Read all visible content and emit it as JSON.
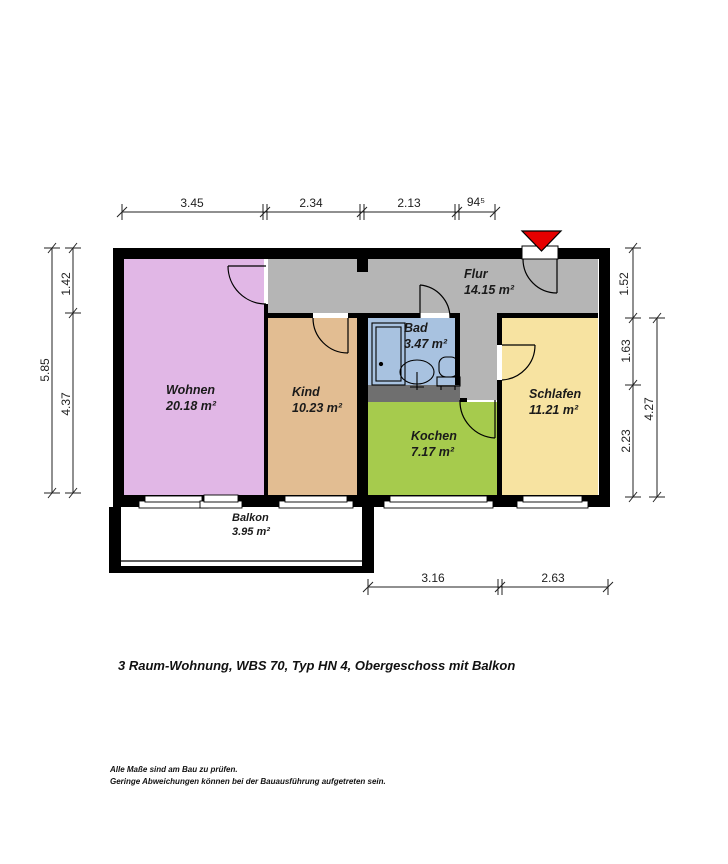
{
  "plan": {
    "rooms": [
      {
        "name": "Wohnen",
        "area": "20.18 m²",
        "color": "#e1b7e6"
      },
      {
        "name": "Kind",
        "area": "10.23 m²",
        "color": "#e2bd92"
      },
      {
        "name": "Flur",
        "area": "14.15 m²",
        "color": "#b5b5b5"
      },
      {
        "name": "Bad",
        "area": "3.47 m²",
        "color": "#a8c2e0"
      },
      {
        "name": "Kochen",
        "area": "7.17 m²",
        "color": "#a6cb4d"
      },
      {
        "name": "Schlafen",
        "area": "11.21 m²",
        "color": "#f7e3a1"
      },
      {
        "name": "Balkon",
        "area": "3.95 m²",
        "color": "#ffffff"
      }
    ],
    "dims": {
      "top": [
        "3.45",
        "2.34",
        "2.13",
        "94⁵"
      ],
      "left": [
        "1.42",
        "5.85",
        "4.37"
      ],
      "right": [
        "1.52",
        "1.63",
        "2.23",
        "4.27"
      ],
      "bottom": [
        "3.16",
        "2.63"
      ]
    },
    "icons": {
      "entrance": "entrance-arrow",
      "bathroom_fixtures": [
        "shower",
        "washbasin",
        "wc"
      ]
    },
    "entrance_marker_color": "#e60000"
  },
  "caption": "3 Raum-Wohnung, WBS 70, Typ HN 4, Obergeschoss mit Balkon",
  "footer": [
    "Alle Maße sind am Bau zu prüfen.",
    "Geringe Abweichungen können bei der Bauausführung aufgetreten sein."
  ]
}
